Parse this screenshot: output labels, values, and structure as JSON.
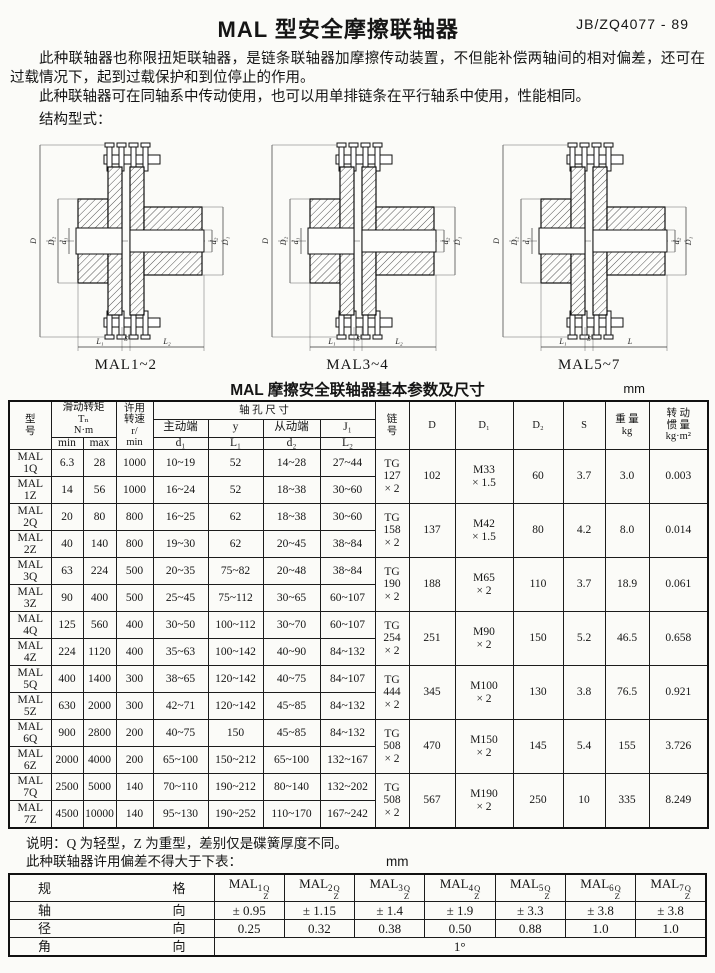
{
  "page": {
    "title": "MAL 型安全摩擦联轴器",
    "standard": "JB/ZQ4077 - 89",
    "para1": "此种联轴器也称限扭矩联轴器，是链条联轴器加摩擦传动装置，不但能补偿两轴间的相对偏差，还可在过载情况下，起到过载保护和到位停止的作用。",
    "para2": "此种联轴器可在同轴系中传动使用，也可以用单排链条在平行轴系中使用，性能相同。",
    "structure_label": "结构型式："
  },
  "figures": {
    "captions": [
      "MAL1~2",
      "MAL3~4",
      "MAL5~7"
    ],
    "dim_labels": {
      "outer": "D",
      "flange": "D₂",
      "bore_left": "d₁",
      "bore_right": "d₂",
      "hub_right": "D₁"
    },
    "bottom_labels": [
      [
        "L₁",
        "S",
        "L₂"
      ],
      [
        "L₁",
        "S",
        "L₂"
      ],
      [
        "L₁",
        "S",
        "L"
      ]
    ]
  },
  "main_table": {
    "title": "MAL 摩擦安全联轴器基本参数及尺寸",
    "unit": "mm",
    "headers": {
      "model": "型\n号",
      "torque": "滑动转矩\nTₙ\nN·m",
      "min": "min",
      "max": "max",
      "speed": "许用\n转速\nr/\nmin",
      "bore": "轴  孔  尺  寸",
      "driving": "主动端",
      "y": "y",
      "driven": "从动端",
      "j1": "J₁",
      "d1": "d₁",
      "L1": "L₁",
      "d2": "d₂",
      "L2": "L₂",
      "chain": "链\n号",
      "D": "D",
      "D1": "D₁",
      "D2": "D₂",
      "S": "S",
      "weight": "重 量\nkg",
      "inertia": "转 动\n惯 量\nkg·m²"
    },
    "groups": [
      {
        "rows": [
          [
            "MAL\n1Q",
            "6.3",
            "28",
            "1000",
            "10~19",
            "52",
            "14~28",
            "27~44"
          ],
          [
            "MAL\n1Z",
            "14",
            "56",
            "1000",
            "16~24",
            "52",
            "18~38",
            "30~60"
          ]
        ],
        "chain": "TG\n127\n× 2",
        "D": "102",
        "D1": "M33\n× 1.5",
        "D2": "60",
        "S": "3.7",
        "weight": "3.0",
        "inertia": "0.003"
      },
      {
        "rows": [
          [
            "MAL\n2Q",
            "20",
            "80",
            "800",
            "16~25",
            "62",
            "18~38",
            "30~60"
          ],
          [
            "MAL\n2Z",
            "40",
            "140",
            "800",
            "19~30",
            "62",
            "20~45",
            "38~84"
          ]
        ],
        "chain": "TG\n158\n× 2",
        "D": "137",
        "D1": "M42\n× 1.5",
        "D2": "80",
        "S": "4.2",
        "weight": "8.0",
        "inertia": "0.014"
      },
      {
        "rows": [
          [
            "MAL\n3Q",
            "63",
            "224",
            "500",
            "20~35",
            "75~82",
            "20~48",
            "38~84"
          ],
          [
            "MAL\n3Z",
            "90",
            "400",
            "500",
            "25~45",
            "75~112",
            "30~65",
            "60~107"
          ]
        ],
        "chain": "TG\n190\n× 2",
        "D": "188",
        "D1": "M65\n× 2",
        "D2": "110",
        "S": "3.7",
        "weight": "18.9",
        "inertia": "0.061"
      },
      {
        "rows": [
          [
            "MAL\n4Q",
            "125",
            "560",
            "400",
            "30~50",
            "100~112",
            "30~70",
            "60~107"
          ],
          [
            "MAL\n4Z",
            "224",
            "1120",
            "400",
            "35~63",
            "100~142",
            "40~90",
            "84~132"
          ]
        ],
        "chain": "TG\n254\n× 2",
        "D": "251",
        "D1": "M90\n× 2",
        "D2": "150",
        "S": "5.2",
        "weight": "46.5",
        "inertia": "0.658"
      },
      {
        "rows": [
          [
            "MAL\n5Q",
            "400",
            "1400",
            "300",
            "38~65",
            "120~142",
            "40~75",
            "84~107"
          ],
          [
            "MAL\n5Z",
            "630",
            "2000",
            "300",
            "42~71",
            "120~142",
            "45~85",
            "84~132"
          ]
        ],
        "chain": "TG\n444\n× 2",
        "D": "345",
        "D1": "M100\n× 2",
        "D2": "130",
        "S": "3.8",
        "weight": "76.5",
        "inertia": "0.921"
      },
      {
        "rows": [
          [
            "MAL\n6Q",
            "900",
            "2800",
            "200",
            "40~75",
            "150",
            "45~85",
            "84~132"
          ],
          [
            "MAL\n6Z",
            "2000",
            "4000",
            "200",
            "65~100",
            "150~212",
            "65~100",
            "132~167"
          ]
        ],
        "chain": "TG\n508\n× 2",
        "D": "470",
        "D1": "M150\n× 2",
        "D2": "145",
        "S": "5.4",
        "weight": "155",
        "inertia": "3.726"
      },
      {
        "rows": [
          [
            "MAL\n7Q",
            "2500",
            "5000",
            "140",
            "70~110",
            "190~212",
            "80~140",
            "132~202"
          ],
          [
            "MAL\n7Z",
            "4500",
            "10000",
            "140",
            "95~130",
            "190~252",
            "110~170",
            "167~242"
          ]
        ],
        "chain": "TG\n508\n× 2",
        "D": "567",
        "D1": "M190\n× 2",
        "D2": "250",
        "S": "10",
        "weight": "335",
        "inertia": "8.249"
      }
    ]
  },
  "notes": {
    "note1": "说明：Q 为轻型，Z 为重型，差别仅是碟簧厚度不同。",
    "note2": "此种联轴器许用偏差不得大于下表：",
    "note2_unit": "mm"
  },
  "tolerance_table": {
    "corner_label": "规 格",
    "spec_base": "MAL",
    "spec_upper": "Q",
    "spec_lower": "Z",
    "spec_indices": [
      "1",
      "2",
      "3",
      "4",
      "5",
      "6",
      "7"
    ],
    "rows": [
      {
        "label": "轴 向",
        "values": [
          "± 0.95",
          "± 1.15",
          "± 1.4",
          "± 1.9",
          "± 3.3",
          "± 3.8",
          "± 3.8"
        ]
      },
      {
        "label": "径 向",
        "values": [
          "0.25",
          "0.32",
          "0.38",
          "0.50",
          "0.88",
          "1.0",
          "1.0"
        ]
      },
      {
        "label": "角 向",
        "values": [
          "1°"
        ],
        "span_all": true
      }
    ]
  }
}
